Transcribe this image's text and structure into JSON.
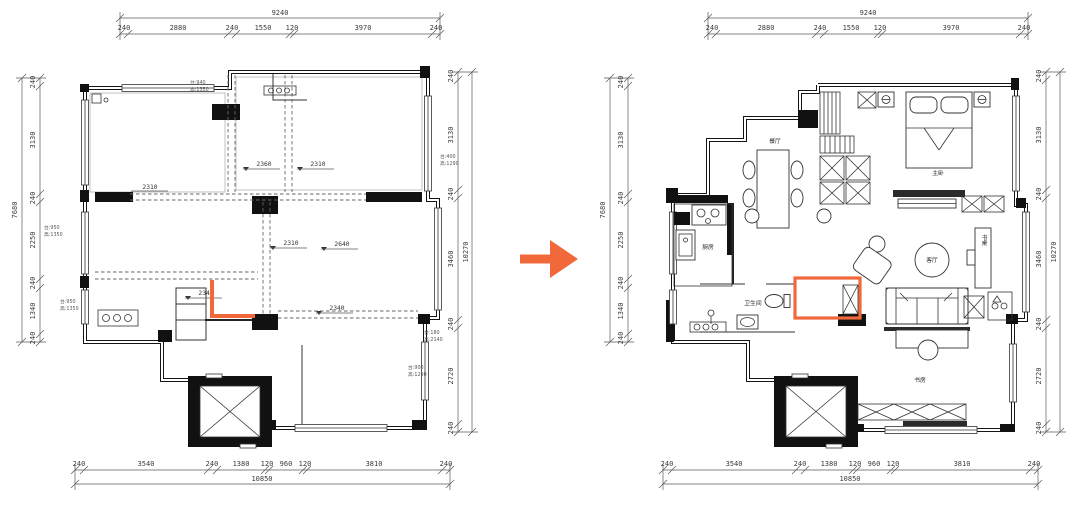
{
  "colors": {
    "accent": "#f1683b"
  },
  "dims": {
    "top": {
      "total": "9240",
      "segs": [
        "240",
        "2880",
        "240",
        "1550",
        "120",
        "3970",
        "240"
      ]
    },
    "bottom": {
      "total": "10850",
      "segs": [
        "240",
        "3540",
        "240",
        "1380",
        "120",
        "960",
        "120",
        "3810",
        "240"
      ]
    },
    "left": {
      "total": "7680",
      "segs": [
        "240",
        "3130",
        "240",
        "2250",
        "240",
        "1340",
        "240"
      ]
    },
    "right": {
      "total": "10270",
      "segs": [
        "240",
        "3130",
        "240",
        "3460",
        "240",
        "2720",
        "240"
      ]
    }
  },
  "left_plan": {
    "interior_dims": {
      "a": "2360",
      "b": "2310",
      "c": "2310",
      "d": "2310",
      "e": "2640",
      "f": "2340",
      "g": "2340"
    },
    "notes": {
      "n1": {
        "l1": "台:940",
        "l2": "高:1350"
      },
      "n2": {
        "l1": "台:950",
        "l2": "高:1350"
      },
      "n3": {
        "l1": "台:950",
        "l2": "高:1350"
      },
      "n4": {
        "l1": "台:400",
        "l2": "高:1290"
      },
      "n5": {
        "l1": "台:180",
        "l2": "高:2140"
      },
      "n6": {
        "l1": "台:900",
        "l2": "高:1290"
      }
    }
  },
  "right_plan": {
    "rooms": {
      "dining": "餐厅",
      "master": "主卧",
      "kitchen": "厨房",
      "bath": "卫生间",
      "living": "客厅",
      "desk": "书桌",
      "study": "书房"
    }
  }
}
